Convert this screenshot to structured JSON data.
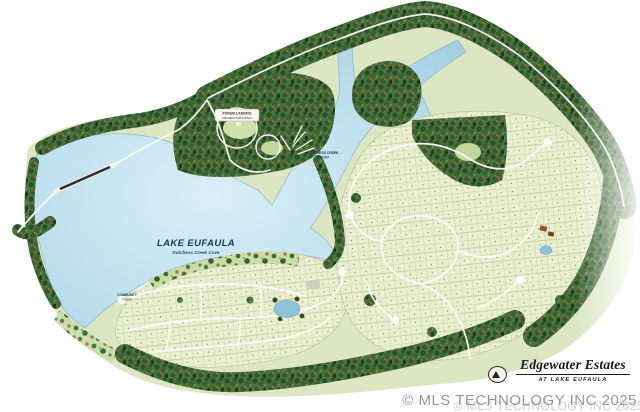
{
  "map": {
    "lake_label": {
      "name": "LAKE EUFAULA",
      "subtitle": "Dutchess Creek Cove"
    },
    "labels": {
      "top_road": "Porum Landing Road",
      "recreation_area_line1": "PORUM LANDING",
      "recreation_area_line2": "RECREATION AREA",
      "marina_line1": "DUTCHESS CREEK",
      "marina_line2": "MARINA",
      "dock_line1": "COMMUNITY",
      "dock_line2": "DOCK"
    },
    "colors": {
      "water": "#bde0ee",
      "land": "#dce6c2",
      "lots": "#e9efce",
      "tree_dark": "#2a4f24",
      "tree_autumn": "#aa6134",
      "road": "#ffffff",
      "pond": "#8fc3da",
      "label_navy": "#16395c",
      "watermark_gray": "#9b9b9b"
    }
  },
  "title_block": {
    "name": "Edgewater Estates",
    "subtitle": "AT LAKE EUFAULA"
  },
  "watermark": {
    "text": "© MLS TECHNOLOGY INC 2025"
  }
}
